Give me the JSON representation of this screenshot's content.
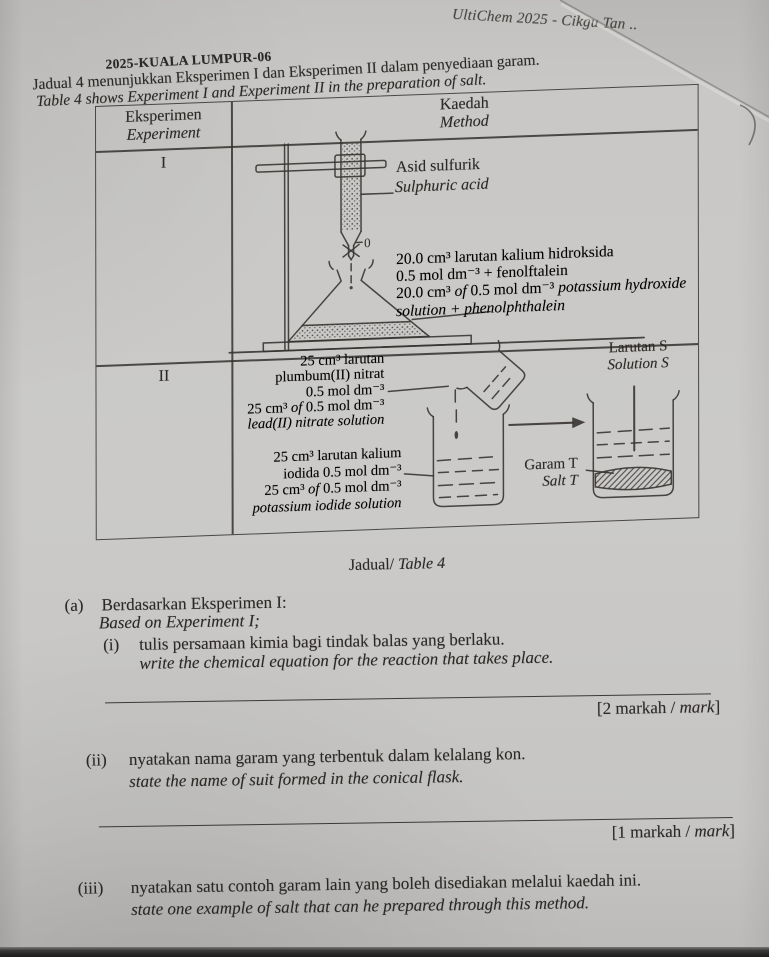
{
  "meta": {
    "watermark": "UltiChem 2025 - Cikgu Tan ..",
    "doc_code": "2025-KUALA LUMPUR-06",
    "intro_ms": "Jadual 4 menunjukkan Eksperimen I dan Eksperimen II dalam penyediaan garam.",
    "intro_en": "Table 4 shows Experiment I and Experiment II in the preparation of salt.",
    "caption_runs": [
      {
        "t": "Jadual/ "
      },
      {
        "t": "Table 4",
        "i": true
      }
    ]
  },
  "table": {
    "header": {
      "exp_ms": "Eksperimen",
      "exp_en": "Experiment",
      "method_ms": "Kaedah",
      "method_en": "Method"
    },
    "row1": {
      "label": "I",
      "acid_ms": "Asid sulfurik",
      "acid_en": "Sulphuric acid",
      "burette_reading": "0",
      "flask_lines": [
        [
          {
            "t": "20.0 cm³ larutan kalium hidroksida"
          }
        ],
        [
          {
            "t": "0.5 mol dm⁻³ + fenolftalein"
          }
        ],
        [
          {
            "t": "20.0 cm³ "
          },
          {
            "t": "of",
            "i": true
          },
          {
            "t": " 0.5 mol dm⁻³ "
          },
          {
            "t": "potassium hydroxide",
            "i": true
          }
        ],
        [
          {
            "t": "solution + phenolphthalein",
            "i": true
          }
        ]
      ]
    },
    "row2": {
      "label": "II",
      "reagent1_lines": [
        [
          {
            "t": "25 cm³ larutan"
          }
        ],
        [
          {
            "t": "plumbum(II) nitrat"
          }
        ],
        [
          {
            "t": "0.5 mol dm⁻³"
          }
        ],
        [
          {
            "t": "25 cm³ "
          },
          {
            "t": "of",
            "i": true
          },
          {
            "t": " 0.5 mol dm⁻³"
          }
        ],
        [
          {
            "t": "lead(II) nitrate solution",
            "i": true
          }
        ]
      ],
      "reagent2_lines": [
        [
          {
            "t": "25 cm³ larutan kalium"
          }
        ],
        [
          {
            "t": "iodida 0.5 mol dm⁻³"
          }
        ],
        [
          {
            "t": "25 cm³ "
          },
          {
            "t": "of",
            "i": true
          },
          {
            "t": " 0.5 mol dm⁻³"
          }
        ],
        [
          {
            "t": "potassium iodide solution",
            "i": true
          }
        ]
      ],
      "solution_ms": "Larutan S",
      "solution_en": "Solution S",
      "salt_ms": "Garam T",
      "salt_en": "Salt T"
    }
  },
  "questions": {
    "a_num": "(a)",
    "a_ms": "Berdasarkan Eksperimen I:",
    "a_en": "Based on Experiment I;",
    "items": [
      {
        "num": "(i)",
        "ms": "tulis persamaan kimia bagi tindak balas yang berlaku.",
        "en": "write the chemical equation for the reaction that takes place.",
        "marks_runs": [
          {
            "t": "[2 markah / "
          },
          {
            "t": "mark",
            "i": true
          },
          {
            "t": "]"
          }
        ]
      },
      {
        "num": "(ii)",
        "ms": "nyatakan nama garam yang terbentuk dalam kelalang kon.",
        "en": "state the name of suit formed in the conical flask.",
        "marks_runs": [
          {
            "t": "[1 markah / "
          },
          {
            "t": "mark",
            "i": true
          },
          {
            "t": "]"
          }
        ]
      },
      {
        "num": "(iii)",
        "ms": "nyatakan satu contoh garam lain yang boleh disediakan melalui kaedah ini.",
        "en": "state one example of salt that can he prepared through this method."
      }
    ]
  },
  "colors": {
    "paper": "#c9c8c6",
    "ink": "#2b2927",
    "line": "#3a3836"
  }
}
